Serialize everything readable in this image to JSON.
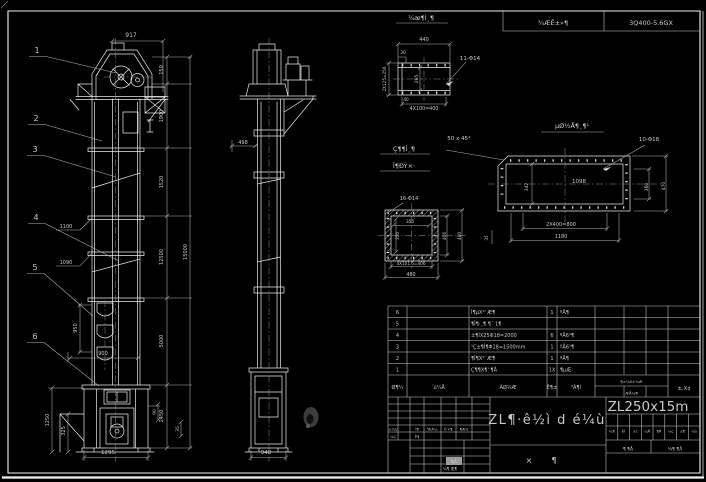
{
  "header": {
    "left": "¾ÆÊ±»¶",
    "right": "3Q400-5.6GX"
  },
  "titleblock": {
    "main_title": "ZL¶·ê½ì d é¼ù",
    "model": "ZL250x15m",
    "assembly_left": "×",
    "assembly_right": "¶",
    "sheet_left": "¶ ¶Å",
    "sheet_right": "¼¶ ¶Å",
    "stamp_cell": "¶Å",
    "bottom_left": "¼¶ Æ¶",
    "tiny_cells": [
      "¼¶",
      "ÊÌ",
      "±1",
      "¼Å",
      "¶Å",
      "¼ç",
      "±¶",
      "¼ù"
    ]
  },
  "bom": {
    "headers": {
      "no": "Ø¶¼",
      "dwg": "´ü¼Å",
      "name": "ÃØ¾Æ",
      "qty": "Ê¶±",
      "mat": "²Ã¶Ì",
      "weight": "¶±¼X±¼Æ",
      "weight_sub": "ÆÅ¼¶",
      "remark": "±,X¢"
    },
    "rows": [
      {
        "no": "6",
        "desc": "Î¶µX¹' Æ¶",
        "qty": "1",
        "mat": "ºÅ¶"
      },
      {
        "no": "5",
        "desc": "¶Î¶·¸¶ ¶´ 1¶",
        "qty": "",
        "mat": ""
      },
      {
        "no": "4",
        "desc": "±¶ÌX25Φ18=2000",
        "qty": "6",
        "mat": "ºÅ6¹¶"
      },
      {
        "no": "3",
        "desc": "¹Ç±¶Ì¶Φ18=1500mm",
        "qty": "1",
        "mat": "ºÅ6¹¶"
      },
      {
        "no": "2",
        "desc": "¶Î¶X¹' Æ¶",
        "qty": "1",
        "mat": "ºÅ¶"
      },
      {
        "no": "1",
        "desc": "Ç¶¶X¶' ¶Å",
        "qty": "1X",
        "mat": "¶µÆ·"
      }
    ]
  },
  "balloons": [
    {
      "n": "1",
      "x": 37,
      "y": 53,
      "tx": 116,
      "ty": 73
    },
    {
      "n": "2",
      "x": 36,
      "y": 121,
      "tx": 102,
      "ty": 141
    },
    {
      "n": "3",
      "x": 35,
      "y": 152,
      "tx": 116,
      "ty": 177
    },
    {
      "n": "4",
      "x": 36,
      "y": 220,
      "tx": 119,
      "ty": 261
    },
    {
      "n": "5",
      "x": 35,
      "y": 270,
      "tx": 93,
      "ty": 316
    },
    {
      "n": "6",
      "x": 35,
      "y": 339,
      "tx": 99,
      "ty": 386
    }
  ],
  "labels": [
    {
      "t": "917",
      "x": 131,
      "y": 37,
      "s": 6
    },
    {
      "t": "150",
      "x": 163,
      "y": 70,
      "r": 1,
      "s": 5
    },
    {
      "t": "1900",
      "x": 163,
      "y": 116,
      "r": 1,
      "s": 5
    },
    {
      "t": "1520",
      "x": 163,
      "y": 182,
      "r": 1,
      "s": 5
    },
    {
      "t": "12500",
      "x": 163,
      "y": 257,
      "r": 1,
      "s": 5
    },
    {
      "t": "5000",
      "x": 163,
      "y": 341,
      "r": 1,
      "s": 5
    },
    {
      "t": "2450",
      "x": 163,
      "y": 416,
      "r": 1,
      "s": 5
    },
    {
      "t": "15000",
      "x": 187,
      "y": 252,
      "r": 1,
      "s": 5
    },
    {
      "t": "1100",
      "x": 66,
      "y": 228,
      "s": 5
    },
    {
      "t": "1090",
      "x": 66,
      "y": 264,
      "s": 5
    },
    {
      "t": "950",
      "x": 77,
      "y": 328,
      "r": 1,
      "s": 5
    },
    {
      "t": "900",
      "x": 103,
      "y": 355,
      "s": 5
    },
    {
      "t": "1250",
      "x": 49,
      "y": 420,
      "r": 1,
      "s": 5
    },
    {
      "t": "325",
      "x": 65,
      "y": 431,
      "r": 1,
      "s": 5
    },
    {
      "t": "1295",
      "x": 108,
      "y": 454,
      "s": 5.5
    },
    {
      "t": "90",
      "x": 156,
      "y": 412,
      "r": 1,
      "s": 4.5
    },
    {
      "t": "35",
      "x": 179,
      "y": 429,
      "r": 1,
      "s": 4.5
    },
    {
      "t": "498",
      "x": 243,
      "y": 144,
      "s": 5
    },
    {
      "t": "948",
      "x": 266,
      "y": 454,
      "s": 5.5
    },
    {
      "t": "¼æ¶Ì¸¶",
      "x": 421,
      "y": 20,
      "s": 6.5
    },
    {
      "t": "440",
      "x": 424,
      "y": 41,
      "s": 5
    },
    {
      "t": "30",
      "x": 403,
      "y": 54,
      "s": 4.5
    },
    {
      "t": "2X125=250",
      "x": 386,
      "y": 79,
      "r": 1,
      "s": 4.2
    },
    {
      "t": "265",
      "x": 418,
      "y": 79,
      "r": 1,
      "s": 4.5
    },
    {
      "t": "40",
      "x": 406,
      "y": 101,
      "s": 4.2
    },
    {
      "t": "4X100=400",
      "x": 424,
      "y": 110,
      "s": 4.8
    },
    {
      "t": "11-Φ14",
      "x": 470,
      "y": 60,
      "s": 5.5
    },
    {
      "t": "Ç¶¶Ì¸¶",
      "x": 404,
      "y": 151,
      "s": 6.5
    },
    {
      "t": "Ï¶ÐÝ×·",
      "x": 404,
      "y": 168,
      "s": 6.5
    },
    {
      "t": "16-Φ14",
      "x": 409,
      "y": 200,
      "s": 5
    },
    {
      "t": "355",
      "x": 410,
      "y": 223,
      "s": 4.2
    },
    {
      "t": "350",
      "x": 399,
      "y": 236,
      "r": 1,
      "s": 4.2
    },
    {
      "t": "406",
      "x": 446,
      "y": 236,
      "r": 1,
      "s": 4.2
    },
    {
      "t": "480",
      "x": 461,
      "y": 236,
      "r": 1,
      "s": 4.2
    },
    {
      "t": "4X101.5=406",
      "x": 411,
      "y": 265,
      "s": 4.2
    },
    {
      "t": "480",
      "x": 411,
      "y": 276,
      "s": 4.8
    },
    {
      "t": "µØ½Å¶¸¶¹",
      "x": 572,
      "y": 128,
      "s": 6.5
    },
    {
      "t": "50 x 45°",
      "x": 459,
      "y": 140,
      "s": 5.5
    },
    {
      "t": "10-Φ18",
      "x": 649,
      "y": 141,
      "s": 5.5
    },
    {
      "t": "1098",
      "x": 579,
      "y": 183,
      "s": 5.5
    },
    {
      "t": "342",
      "x": 528,
      "y": 187,
      "r": 1,
      "s": 4.5
    },
    {
      "t": "360",
      "x": 648,
      "y": 187,
      "r": 1,
      "s": 4.5
    },
    {
      "t": "470",
      "x": 665,
      "y": 186,
      "r": 1,
      "s": 4.5
    },
    {
      "t": "2X400=800",
      "x": 561,
      "y": 226,
      "s": 5
    },
    {
      "t": "1180",
      "x": 561,
      "y": 238,
      "s": 5
    },
    {
      "t": "35",
      "x": 488,
      "y": 238,
      "r": 1,
      "s": 4.2
    },
    {
      "t": "±¼Ç",
      "x": 393,
      "y": 430.5,
      "s": 3.6
    },
    {
      "t": "Ì¶",
      "x": 417,
      "y": 430.5,
      "s": 3.6
    },
    {
      "t": "¹ÆÄ¼",
      "x": 432,
      "y": 430.5,
      "s": 3.6
    },
    {
      "t": "©×¶",
      "x": 448,
      "y": 430.5,
      "s": 3.6
    },
    {
      "t": "¶ÆÚ",
      "x": 464,
      "y": 430.5,
      "s": 3.6
    },
    {
      "t": "¼Ç",
      "x": 393,
      "y": 438,
      "s": 3.6
    },
    {
      "t": "Ê¶",
      "x": 417,
      "y": 438,
      "s": 3.6
    }
  ]
}
